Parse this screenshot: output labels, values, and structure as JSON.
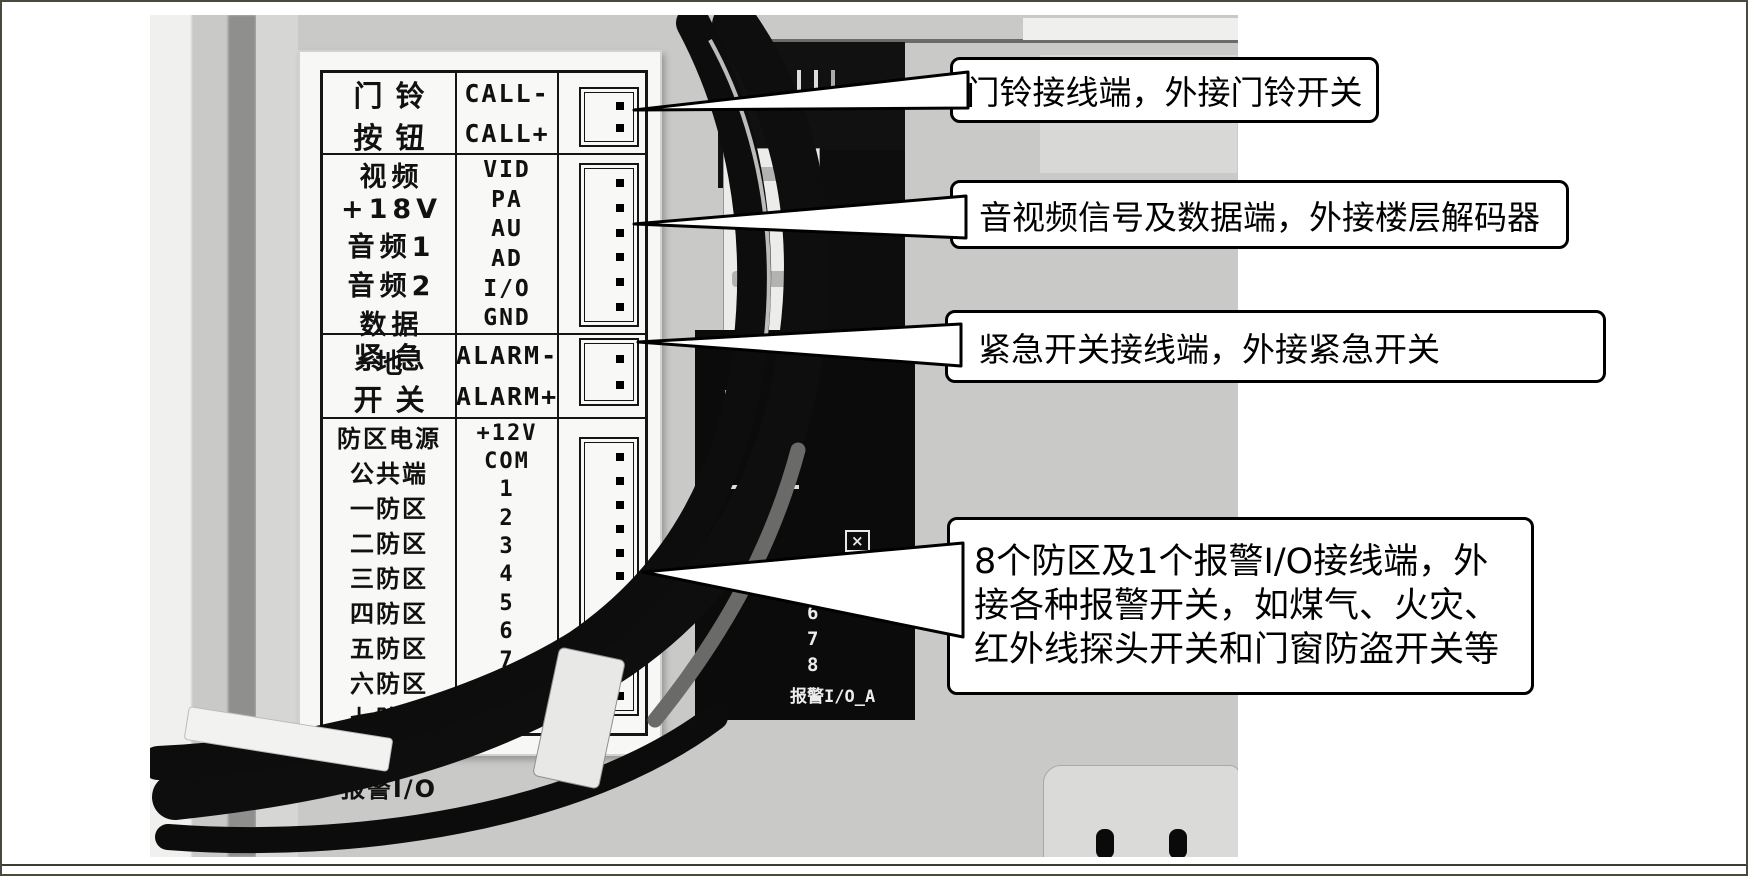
{
  "label_table": {
    "groups": [
      {
        "name": "doorbell",
        "zh": [
          "门铃",
          "按钮"
        ],
        "en": [
          "CALL-",
          "CALL+"
        ],
        "pins": 2
      },
      {
        "name": "av-data",
        "zh": [
          "视频",
          "+18V",
          "音频1",
          "音频2",
          "数据",
          "地"
        ],
        "en": [
          "VID",
          "PA",
          "AU",
          "AD",
          "I/O",
          "GND"
        ],
        "pins": 6
      },
      {
        "name": "emergency",
        "zh": [
          "紧急",
          "开关"
        ],
        "en": [
          "ALARM-",
          "ALARM+"
        ],
        "pins": 2
      },
      {
        "name": "zones",
        "zh": [
          "防区电源",
          "公共端",
          "一防区",
          "二防区",
          "三防区",
          "四防区",
          "五防区",
          "六防区",
          "七防区",
          "八防区",
          "报警I/O"
        ],
        "en": [
          "+12V",
          "COM",
          "1",
          "2",
          "3",
          "4",
          "5",
          "6",
          "7",
          "8",
          "I/O-A"
        ],
        "pins": 11
      }
    ]
  },
  "callouts": [
    {
      "text": "门铃接线端，外接门铃开关"
    },
    {
      "text": "音视频信号及数据端，外接楼层解码器"
    },
    {
      "text": "紧急开关接线端，外接紧急开关"
    },
    {
      "text": "8个防区及1个报警I/O接线端，外接各种报警开关，如煤气、火灾、红外线探头开关和门窗防盗开关等"
    }
  ],
  "pcb_silkscreen": {
    "partial_label_1": "AL",
    "partial_label_2": "AM",
    "zone_numbers": [
      "6",
      "7",
      "8"
    ],
    "alarm_io_label": "报警I/O_A",
    "box_symbol": "×"
  },
  "colors": {
    "photo_gray": "#c9c9c7",
    "panel_white": "#f7f7f5",
    "table_line": "#151515",
    "pcb_black": "#0b0b0b",
    "callout_border": "#000000",
    "page_background": "#ffffff"
  }
}
